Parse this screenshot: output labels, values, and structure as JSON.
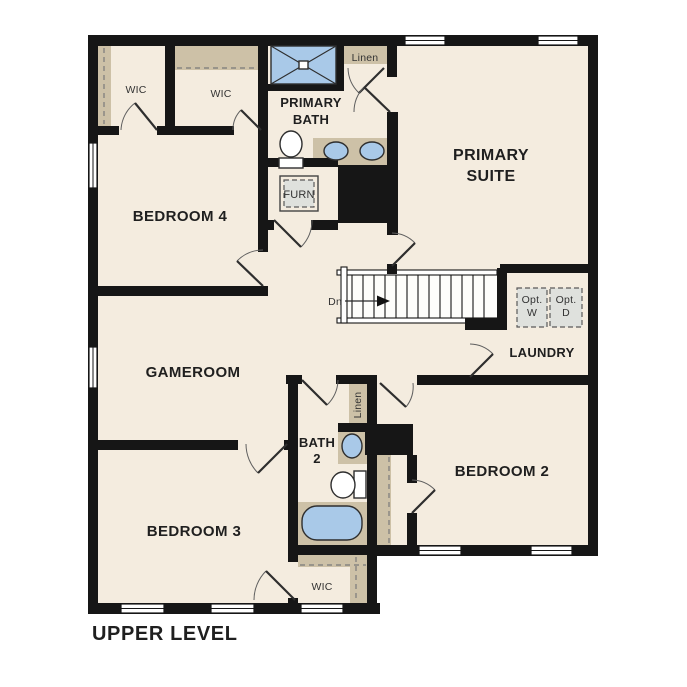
{
  "colors": {
    "floor": "#f4ecdf",
    "wall": "#161616",
    "closet": "#cdc1a7",
    "fixture": "#a9c9e8",
    "appliance": "#dfe1dd",
    "outline": "#2e2e2e",
    "text_dark": "#1f1f1f",
    "text_minor": "#333333"
  },
  "labels": {
    "title": "UPPER LEVEL",
    "primary_suite_line1": "PRIMARY",
    "primary_suite_line2": "SUITE",
    "primary_bath_line1": "PRIMARY",
    "primary_bath_line2": "BATH",
    "bedroom_4": "BEDROOM 4",
    "bedroom_3": "BEDROOM 3",
    "bedroom_2": "BEDROOM 2",
    "gameroom": "GAMEROOM",
    "laundry": "LAUNDRY",
    "bath_2_line1": "BATH",
    "bath_2_line2": "2",
    "wic_primary_left": "WIC",
    "wic_bedroom_4": "WIC",
    "wic_bedroom_3": "WIC",
    "linen_primary_bath": "Linen",
    "linen_bath_2": "Linen",
    "furnace": "FURN",
    "optional_washer_line1": "Opt.",
    "optional_washer_line2": "W",
    "optional_dryer_line1": "Opt.",
    "optional_dryer_line2": "D",
    "stairs_direction": "Dn"
  }
}
